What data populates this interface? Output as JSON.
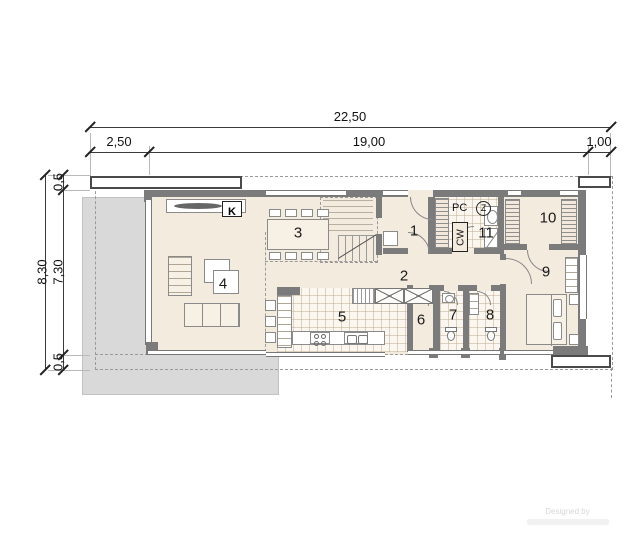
{
  "drawing": {
    "type": "floor-plan",
    "background": "#ffffff"
  },
  "dimensions": {
    "top": {
      "total": "22,50",
      "segments": [
        "2,50",
        "19,00",
        "1,00"
      ]
    },
    "left": {
      "total": "8,30",
      "segments": [
        "0,5",
        "7,30",
        "0,5"
      ]
    }
  },
  "rooms": [
    "1",
    "2",
    "3",
    "4",
    "5",
    "6",
    "7",
    "8",
    "9",
    "10",
    "11"
  ],
  "labels": {
    "fireplace": "K",
    "pc": "PC",
    "z": "Z",
    "cw": "CW"
  },
  "watermark": {
    "line1": "Designed by"
  },
  "colors": {
    "wall": "#7b7b7b",
    "floor": "#f4ebdf",
    "terrace": "#d9d9d9",
    "dash": "#9a9a9a"
  }
}
